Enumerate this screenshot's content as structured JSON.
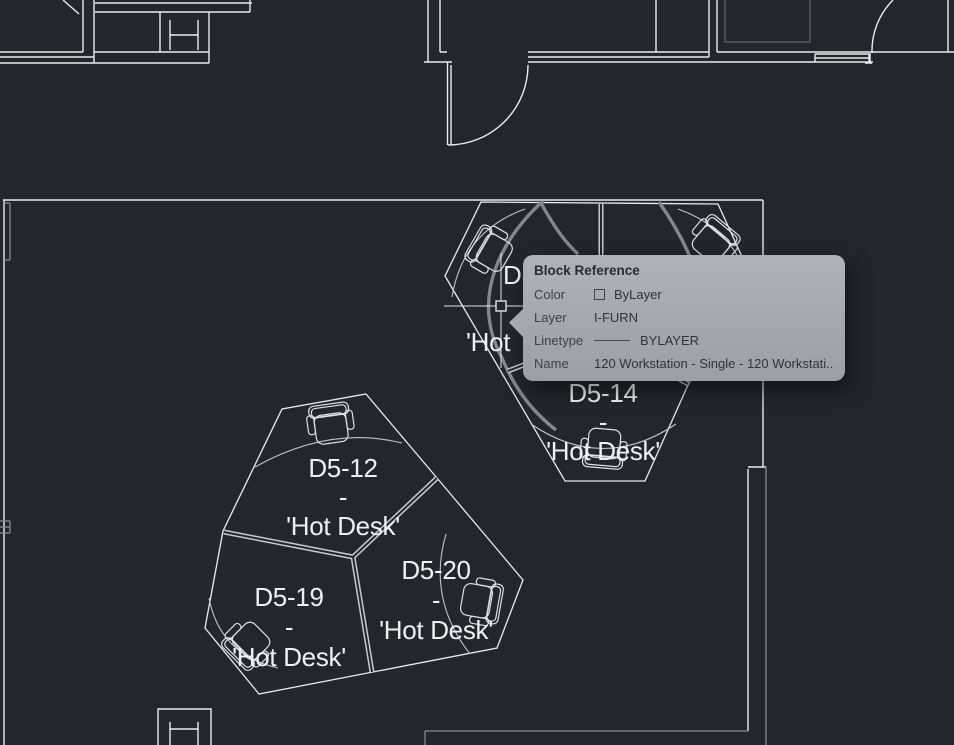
{
  "canvas": {
    "background": "#22262d",
    "wall_color": "#e9ebee",
    "secondary_color": "#8a9098",
    "dim_color": "#5f656d",
    "label_color": "#eef0f2"
  },
  "desk_labels": {
    "d5_12": {
      "code": "D5-12",
      "separator": "-",
      "description": "'Hot Desk'"
    },
    "d5_14": {
      "code": "D5-14",
      "separator": "-",
      "description": "'Hot Desk'"
    },
    "d5_19": {
      "code": "D5-19",
      "separator": "-",
      "description": "'Hot Desk'"
    },
    "d5_20": {
      "code": "D5-20",
      "separator": "-",
      "description": "'Hot Desk'"
    },
    "partial_upper_left": {
      "line1": "D",
      "line3": "'Hot"
    }
  },
  "tooltip": {
    "title": "Block Reference",
    "rows": [
      {
        "label": "Color",
        "value": "ByLayer"
      },
      {
        "label": "Layer",
        "value": "I-FURN"
      },
      {
        "label": "Linetype",
        "value": "BYLAYER"
      },
      {
        "label": "Name",
        "value": "120 Workstation - Single - 120 Workstati..."
      }
    ]
  }
}
